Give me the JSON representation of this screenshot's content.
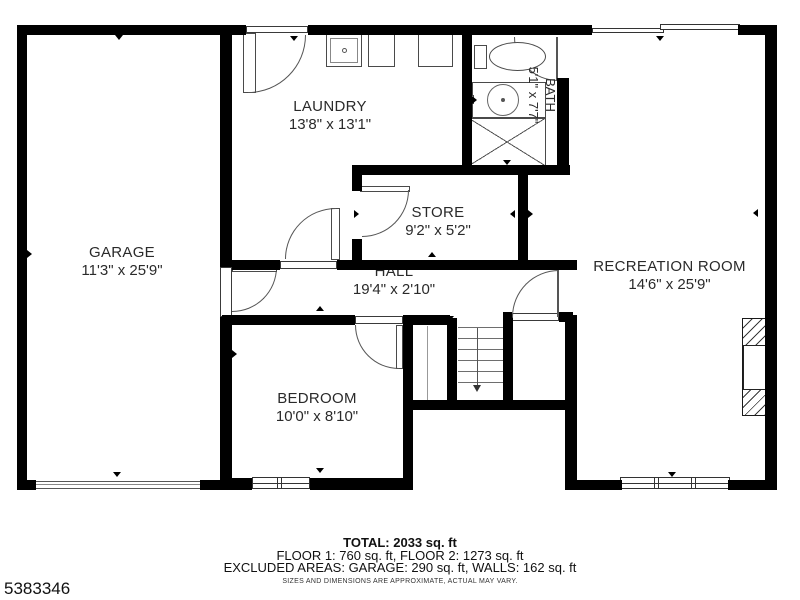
{
  "listing_id": "5383346",
  "rooms": {
    "garage": {
      "name": "GARAGE",
      "dims": "11'3\" x 25'9\""
    },
    "laundry": {
      "name": "LAUNDRY",
      "dims": "13'8\" x 13'1\""
    },
    "bath": {
      "name": "BATH",
      "dims": "5'1\" x 7'7\""
    },
    "store": {
      "name": "STORE",
      "dims": "9'2\" x 5'2\""
    },
    "hall": {
      "name": "HALL",
      "dims": "19'4\" x 2'10\""
    },
    "bedroom": {
      "name": "BEDROOM",
      "dims": "10'0\" x 8'10\""
    },
    "recreation": {
      "name": "RECREATION ROOM",
      "dims": "14'6\" x 25'9\""
    }
  },
  "footer": {
    "total": "TOTAL: 2033 sq. ft",
    "floors": "FLOOR 1: 760 sq. ft, FLOOR 2: 1273 sq. ft",
    "excluded": "EXCLUDED AREAS: GARAGE: 290 sq. ft, WALLS: 162 sq. ft",
    "disclaimer": "SIZES AND DIMENSIONS ARE APPROXIMATE, ACTUAL MAY VARY."
  },
  "colors": {
    "wall": "#000000",
    "background": "#ffffff",
    "text": "#2a2a2a",
    "line": "#555555"
  }
}
